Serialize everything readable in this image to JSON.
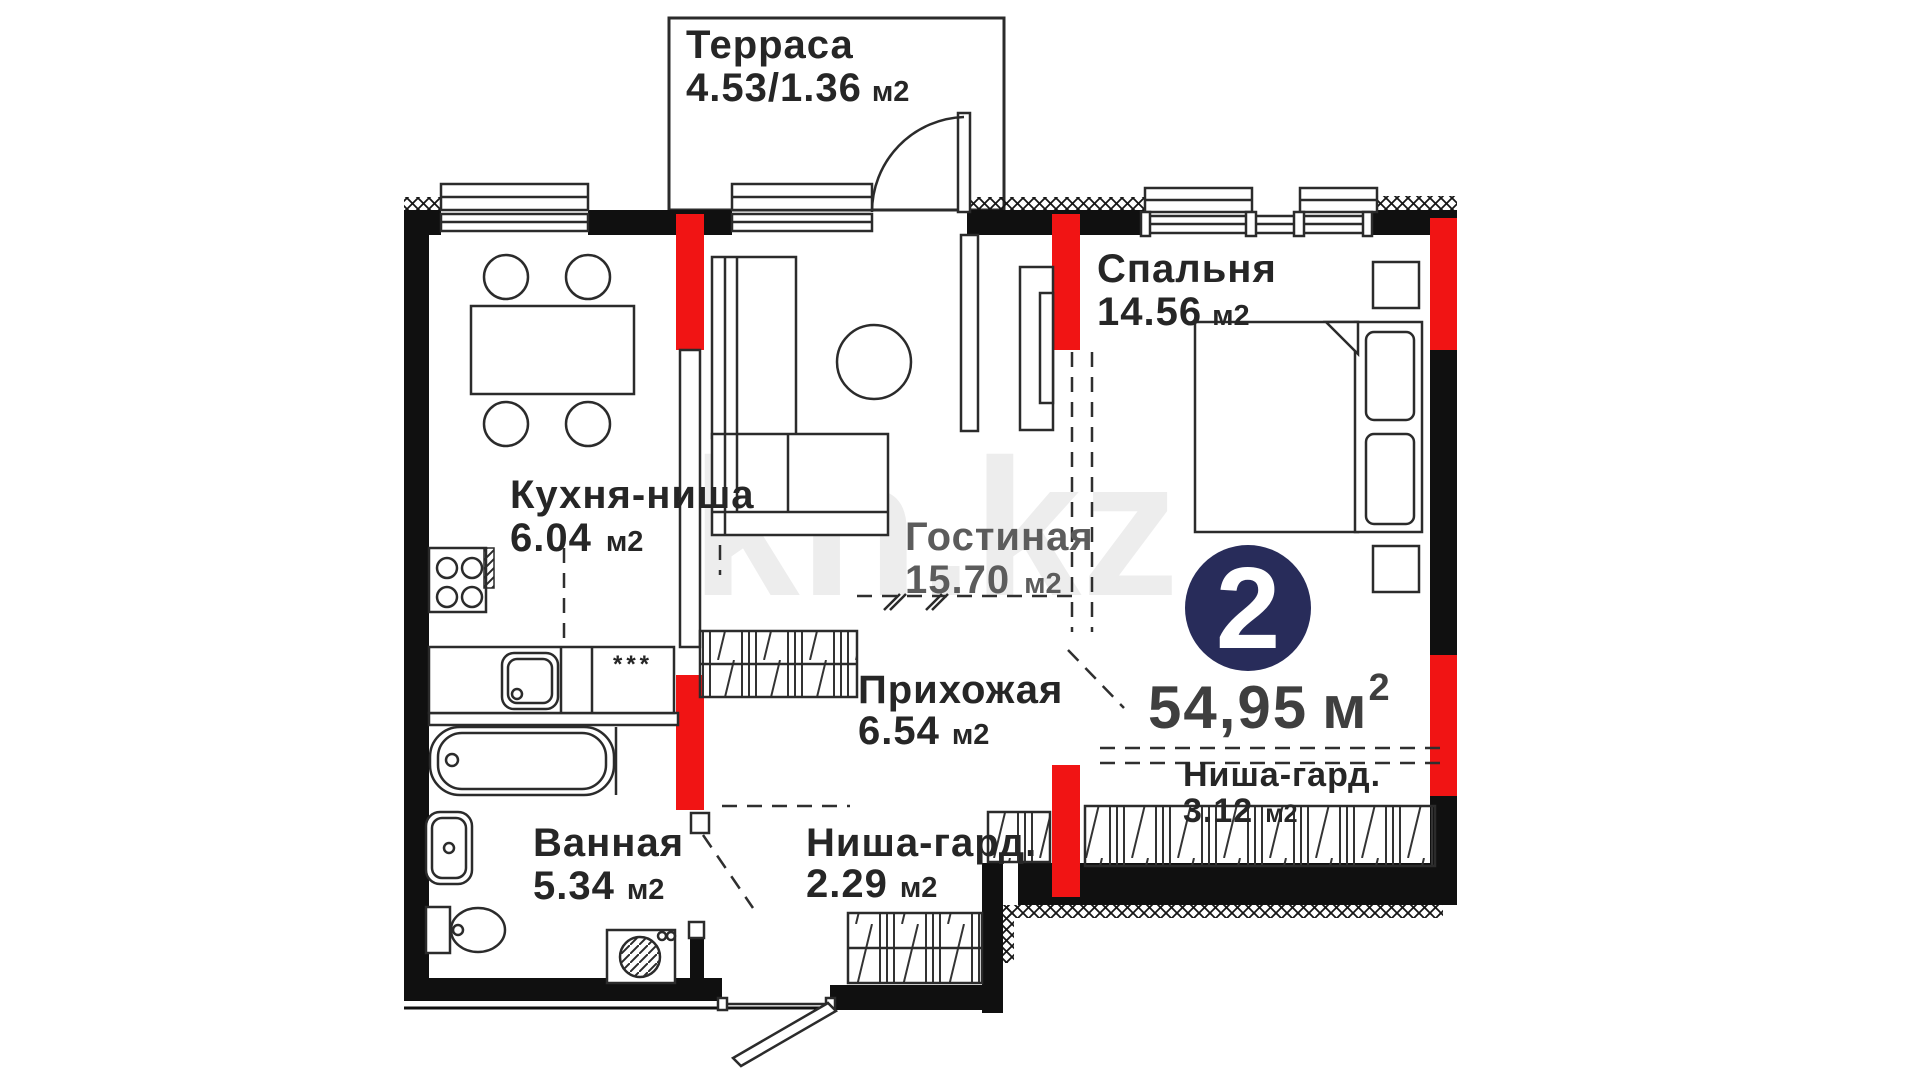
{
  "plan": {
    "watermark": "kn.kz",
    "badge": {
      "rooms_count": "2",
      "area_value": "54,95",
      "area_unit": "м",
      "area_sup": "2"
    },
    "rooms": [
      {
        "name": "Терраса",
        "area": "4.53/1.36",
        "unit": "м2"
      },
      {
        "name": "Спальня",
        "area": "14.56",
        "unit": "м2"
      },
      {
        "name": "Кухня-ниша",
        "area": "6.04",
        "unit": "м2"
      },
      {
        "name": "Гостиная",
        "area": "15.70",
        "unit": "м2"
      },
      {
        "name": "Прихожая",
        "area": "6.54",
        "unit": "м2"
      },
      {
        "name": "Ванная",
        "area": "5.34",
        "unit": "м2"
      },
      {
        "name": "Ниша-гард.",
        "area": "2.29",
        "unit": "м2"
      },
      {
        "name": "Ниша-гард.",
        "area": "3.12",
        "unit": "м2"
      }
    ],
    "symbols": {
      "counter_marks": "***"
    },
    "colors": {
      "wall": "#101010",
      "highlight_red": "#f11414",
      "badge_navy": "#282c5a",
      "label": "#262626",
      "label_muted": "#5c5c5c",
      "total_area": "#3f3f3f",
      "watermark_gray": "#ededed"
    }
  }
}
